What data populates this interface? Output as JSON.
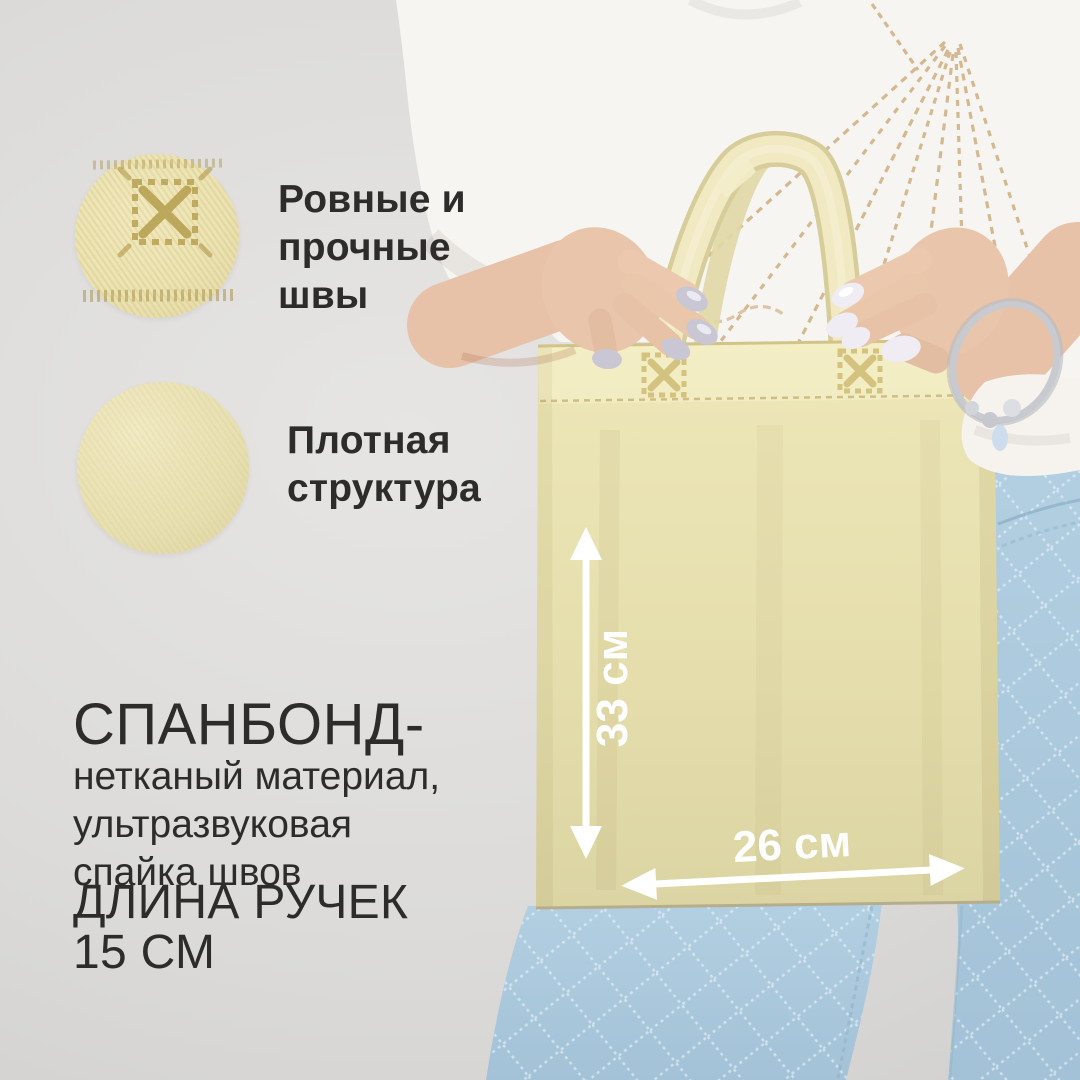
{
  "callouts": [
    {
      "id": "seams",
      "lines": [
        "Ровные и",
        "прочные",
        "швы"
      ]
    },
    {
      "id": "fabric",
      "lines": [
        "Плотная",
        "структура"
      ]
    }
  ],
  "material": {
    "title": "СПАНБОНД-",
    "description_lines": [
      "нетканый материал,",
      "ультразвуковая",
      "спайка швов"
    ],
    "handle_length_lines": [
      "ДЛИНА РУЧЕК",
      "15 СМ"
    ]
  },
  "measurements": {
    "height": "33 см",
    "width": "26 см",
    "handle_length": "15 СМ"
  },
  "icons": [
    "weld-stitch-icon",
    "dimension-arrow-vertical",
    "dimension-arrow-horizontal"
  ],
  "colors": {
    "background": "#d9d8d6",
    "bag": "#e9e2b1",
    "bag_hem": "#f0e9c0",
    "stitch_accent": "#c9b679",
    "tshirt": "#f7f5f1",
    "jeans": "#accadd",
    "skin": "#e8c3a9",
    "arrow": "#ffffff",
    "text": "#2d2c2a"
  }
}
